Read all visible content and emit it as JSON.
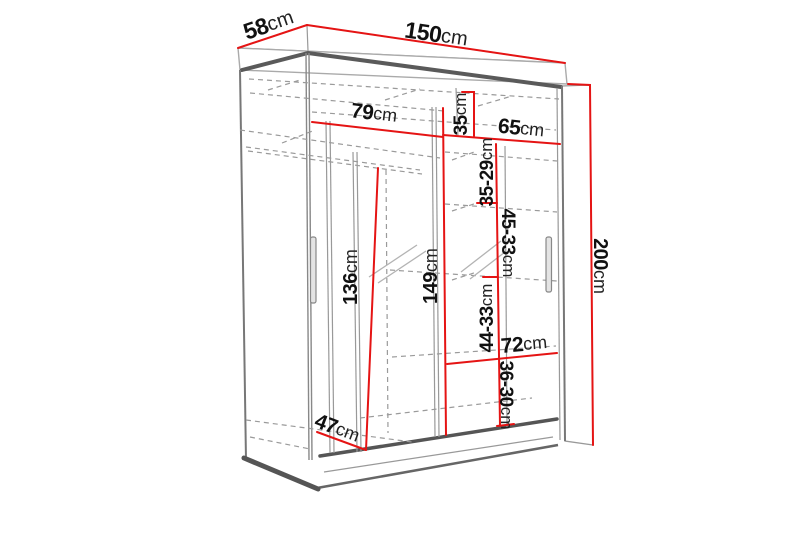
{
  "diagram": {
    "title": "wardrobe-dimension-diagram",
    "subject": "two-door sliding wardrobe line drawing with measurements",
    "colors": {
      "dimension_line": "#e51414",
      "outline_dark": "#555555",
      "outline_light": "#999999",
      "text": "#111111",
      "background": "#ffffff"
    },
    "dims": {
      "d58": {
        "num": "58",
        "unit": "cm"
      },
      "d150": {
        "num": "150",
        "unit": "cm"
      },
      "d200": {
        "num": "200",
        "unit": "cm"
      },
      "d79": {
        "num": "79",
        "unit": "cm"
      },
      "d35": {
        "num": "35",
        "unit": "cm"
      },
      "d65": {
        "num": "65",
        "unit": "cm"
      },
      "d3529": {
        "num": "35-29",
        "unit": "cm"
      },
      "d4533": {
        "num": "45-33",
        "unit": "cm"
      },
      "d136": {
        "num": "136",
        "unit": "cm"
      },
      "d149": {
        "num": "149",
        "unit": "cm"
      },
      "d4433": {
        "num": "44-33",
        "unit": "cm"
      },
      "d72": {
        "num": "72",
        "unit": "cm"
      },
      "d3630": {
        "num": "36-30",
        "unit": "cm"
      },
      "d47": {
        "num": "47",
        "unit": "cm"
      }
    }
  }
}
